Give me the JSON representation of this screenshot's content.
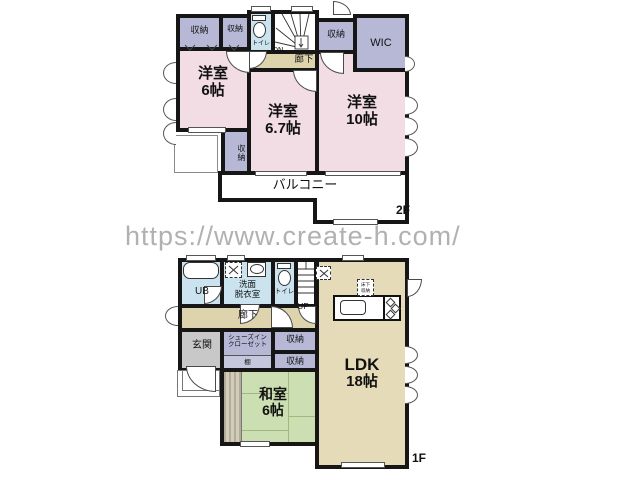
{
  "watermark": "https://www.create-h.com/",
  "colors": {
    "bedroom_pink": "#F2DDE4",
    "closet_purple": "#B6B8D6",
    "hall_beige": "#DDD3AC",
    "ldk_beige": "#E5DBB9",
    "tatami_green": "#CCDFB2",
    "wet_blue": "#CBE3EE",
    "entry_gray": "#C8C8C8",
    "wall": "#161616",
    "watermark_gray": "#B1B1B1"
  },
  "floor2": {
    "floor_label": "2F",
    "room_6": {
      "name": "洋室",
      "size": "6帖"
    },
    "room_67": {
      "name": "洋室",
      "size": "6.7帖"
    },
    "room_10": {
      "name": "洋室",
      "size": "10帖"
    },
    "closet": "収納",
    "wic": "WIC",
    "toilet": "トイレ",
    "hallway": "廊下",
    "stairs_down": "DN",
    "balcony": "バルコニー"
  },
  "floor1": {
    "floor_label": "1F",
    "unit_bath": "UB",
    "washroom": {
      "line1": "洗面",
      "line2": "脱衣室"
    },
    "toilet": "トイレ",
    "stairs_up": "UP",
    "hallway": "廊下",
    "entrance": "玄関",
    "shoes_closet": {
      "line1": "シューズイン",
      "line2": "クローゼット"
    },
    "shelf": "棚",
    "closet": "収納",
    "washitsu": {
      "name": "和室",
      "size": "6帖"
    },
    "ldk": {
      "name": "LDK",
      "size": "18帖"
    },
    "underfloor": {
      "line1": "床下",
      "line2": "収納"
    }
  }
}
